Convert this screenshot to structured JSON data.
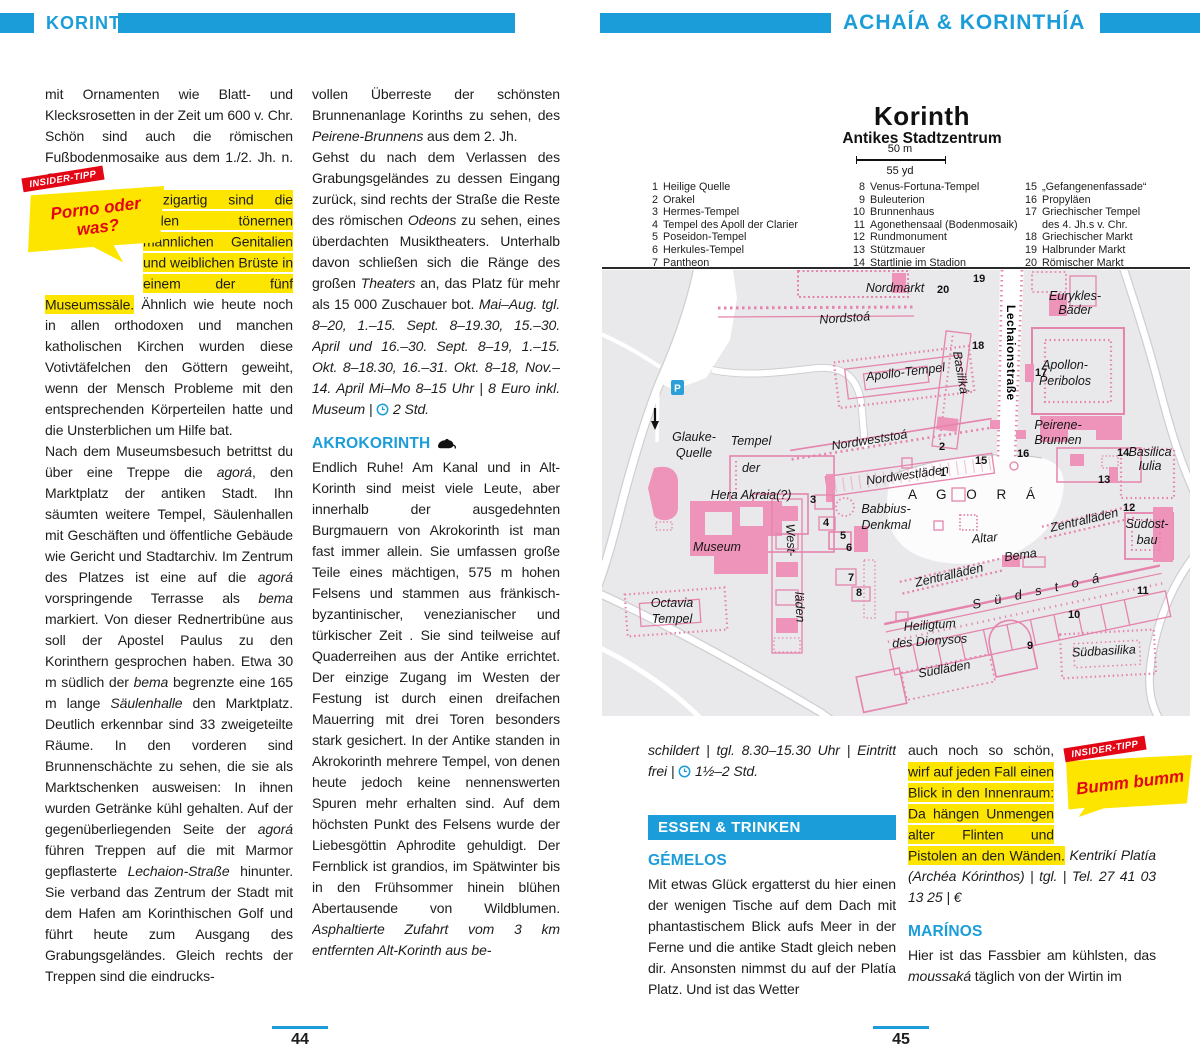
{
  "header": {
    "left_title": "KORINTH",
    "right_title": "ACHAÍA & KORINTHÍA",
    "accent": "#1b9dd9"
  },
  "pages": {
    "left_number": "44",
    "right_number": "45"
  },
  "tips": {
    "left": {
      "ribbon": "INSIDER-TIPP",
      "line1": "Porno oder",
      "line2": "was?"
    },
    "right": {
      "ribbon": "INSIDER-TIPP",
      "line1": "Bumm bumm",
      "line2": ""
    }
  },
  "p44c1": {
    "par1": [
      {
        "t": "mit Ornamenten wie Blatt- und Klecksrosetten in der Zeit um 600 v. Chr. Schön sind auch die römischen Fußbodenmosaike aus dem 1./2. Jh. n. Chr.",
        "s": "n"
      }
    ],
    "par2": [
      {
        "t": "Einzigartig sind die vielen tönernen männlichen Genitalien und weiblichen Brüste in einem der fünf Museumssäle.",
        "s": "m"
      },
      {
        "t": " Ähnlich wie heute noch in allen orthodoxen und manchen katholischen Kirchen wurden diese Votivtäfelchen den Göttern geweiht, wenn der Mensch Probleme mit den entsprechenden Körperteilen hatte und die Unsterblichen um Hilfe bat.",
        "s": "n"
      }
    ],
    "par3": [
      {
        "t": "Nach dem Museumsbesuch betrittst du über eine Treppe die ",
        "s": "n"
      },
      {
        "t": "agorá",
        "s": "i"
      },
      {
        "t": ", den Marktplatz der antiken Stadt. Ihn säumten weitere Tempel, Säulenhallen mit Geschäften und öffentliche Gebäude wie Gericht und Stadtarchiv. Im Zentrum des Platzes ist eine auf die ",
        "s": "n"
      },
      {
        "t": "agorá",
        "s": "i"
      },
      {
        "t": " vorspringende Terrasse als ",
        "s": "n"
      },
      {
        "t": "bema",
        "s": "i"
      },
      {
        "t": " markiert. Von dieser Rednertribüne aus soll der Apostel Paulus zu den Korinthern gesprochen haben. Etwa 30 m südlich der ",
        "s": "n"
      },
      {
        "t": "bema",
        "s": "i"
      },
      {
        "t": " begrenzte eine 165 m lange ",
        "s": "n"
      },
      {
        "t": "Säulenhalle",
        "s": "i"
      },
      {
        "t": " den Marktplatz. Deutlich erkennbar sind 33 zweigeteilte Räume. In den vorderen sind Brunnenschächte zu sehen, die sie als Marktschenken ausweisen: In ihnen wurden Getränke kühl gehalten. Auf der gegenüberliegenden Seite der ",
        "s": "n"
      },
      {
        "t": "agorá",
        "s": "i"
      },
      {
        "t": " führen Treppen auf die mit Marmor gepflasterte ",
        "s": "n"
      },
      {
        "t": "Lechaion-Straße",
        "s": "i"
      },
      {
        "t": " hinunter. Sie verband das Zentrum der Stadt mit dem Hafen am Korinthischen Golf und führt heute zum Ausgang des Grabungsgeländes. Gleich rechts der Treppen sind die eindrucks-",
        "s": "n"
      }
    ]
  },
  "p44c2": {
    "par1": [
      {
        "t": "vollen Überreste der schönsten Brunnenanlage Korinths zu sehen, des ",
        "s": "n"
      },
      {
        "t": "Peirene-Brunnens",
        "s": "i"
      },
      {
        "t": " aus dem 2. Jh.",
        "s": "n"
      }
    ],
    "par2": [
      {
        "t": "Gehst du nach dem Verlassen des Grabungsgeländes zu dessen Eingang zurück, sind rechts der Straße die Reste des römischen ",
        "s": "n"
      },
      {
        "t": "Odeons",
        "s": "i"
      },
      {
        "t": " zu sehen, eines überdachten Musiktheaters. Unterhalb davon schließen sich die Ränge des großen ",
        "s": "n"
      },
      {
        "t": "Theaters",
        "s": "i"
      },
      {
        "t": " an, das Platz für mehr als 15 000 Zuschauer bot. ",
        "s": "n"
      },
      {
        "t": "Mai–Aug. tgl. 8–20, 1.–15. Sept. 8–19.30, 15.–30. April und 16.–30. Sept. 8–19, 1.–15. Okt. 8–18.30, 16.–31. Okt. 8–18, Nov.–14. April Mi–Mo 8–15 Uhr | 8 Euro inkl. Museum | ",
        "s": "i"
      },
      {
        "t": "",
        "s": "clock"
      },
      {
        "t": " 2 Std.",
        "s": "i"
      }
    ],
    "heading": "AKROKORINTH",
    "par3": [
      {
        "t": "Endlich Ruhe! Am Kanal und in Alt-Korinth sind meist viele Leute, aber innerhalb der ausgedehnten Burgmauern von Akrokorinth ist man fast immer allein. Sie umfassen große Teile eines mächtigen, 575 m hohen Felsens und stammen aus fränkisch-byzantinischer, venezianischer und türkischer Zeit . Sie sind teilweise auf Quaderreihen aus der Antike errichtet. Der einzige Zugang im Westen der Festung ist durch einen dreifachen Mauerring mit drei Toren besonders stark gesichert. In der Antike standen in Akrokorinth mehrere Tempel, von denen heute jedoch keine nennenswerten Spuren mehr erhalten sind. Auf dem höchsten Punkt des Felsens wurde der Liebesgöttin Aphrodite gehuldigt. Der Fernblick ist grandios, im Spätwinter bis in den Frühsommer hinein blühen Abertausende von Wildblumen. ",
        "s": "n"
      },
      {
        "t": "Asphaltierte Zufahrt vom 3 km entfernten Alt-Korinth aus be-",
        "s": "i"
      }
    ]
  },
  "p45c1": {
    "par1": [
      {
        "t": "schildert | tgl. 8.30–15.30 Uhr | Eintritt frei | ",
        "s": "i"
      },
      {
        "t": "",
        "s": "clock"
      },
      {
        "t": " 1½–2 Std.",
        "s": "i"
      }
    ],
    "banner": "ESSEN & TRINKEN",
    "heading": "GÉMELOS",
    "par2": [
      {
        "t": "Mit etwas Glück ergatterst du hier einen der wenigen Tische auf dem Dach mit phantastischem Blick aufs Meer in der Ferne und die antike Stadt gleich neben dir. Ansonsten nimmst du auf der Platía Platz. Und ist das Wetter",
        "s": "n"
      }
    ]
  },
  "p45c2": {
    "par1": [
      {
        "t": "auch noch so schön, ",
        "s": "n"
      },
      {
        "t": "wirf auf jeden Fall einen Blick in den Innenraum: Da hängen Unmengen alter Flinten und Pistolen an den Wänden.",
        "s": "m"
      },
      {
        "t": " ",
        "s": "n"
      },
      {
        "t": "Kentrikí Platía (Archéa Kórinthos) | tgl. | Tel. 27 41 03 13 25 | €",
        "s": "i"
      }
    ],
    "heading": "MARÍNOS",
    "par2": [
      {
        "t": "Hier ist das Fassbier am kühlsten, das ",
        "s": "n"
      },
      {
        "t": "moussaká",
        "s": "i"
      },
      {
        "t": " täglich von der Wirtin im",
        "s": "n"
      }
    ]
  },
  "map": {
    "title": "Korinth",
    "subtitle": "Antikes Stadtzentrum",
    "scale_m": "50 m",
    "scale_yd": "55 yd",
    "parking": "P",
    "legend": [
      {
        "n": "1",
        "label": "Heilige Quelle"
      },
      {
        "n": "2",
        "label": "Orakel"
      },
      {
        "n": "3",
        "label": "Hermes-Tempel"
      },
      {
        "n": "4",
        "label": "Tempel des Apoll der Clarier"
      },
      {
        "n": "5",
        "label": "Poseidon-Tempel"
      },
      {
        "n": "6",
        "label": "Herkules-Tempel"
      },
      {
        "n": "7",
        "label": "Pantheon"
      },
      {
        "n": "8",
        "label": "Venus-Fortuna-Tempel"
      },
      {
        "n": "9",
        "label": "Buleuterion"
      },
      {
        "n": "10",
        "label": "Brunnenhaus"
      },
      {
        "n": "11",
        "label": "Agonethensaal (Bodenmosaik)"
      },
      {
        "n": "12",
        "label": "Rundmonument"
      },
      {
        "n": "13",
        "label": "Stützmauer"
      },
      {
        "n": "14",
        "label": "Startlinie im Stadion"
      },
      {
        "n": "15",
        "label": "„Gefangenenfassade“"
      },
      {
        "n": "16",
        "label": "Propyläen"
      },
      {
        "n": "17",
        "label": "Griechischer Tempel",
        "label2": "des 4. Jh.s v. Chr."
      },
      {
        "n": "18",
        "label": "Griechischer Markt"
      },
      {
        "n": "19",
        "label": "Halbrunder Markt"
      },
      {
        "n": "20",
        "label": "Römischer Markt"
      }
    ],
    "labels": {
      "nordmarkt": "Nordmarkt",
      "nordstoa": "Nordstoá",
      "apollotempel": "Apollo-Tempel",
      "eurykles1": "Eurykles-",
      "eurykles2": "Bäder",
      "peribolos1": "Apollon-",
      "peribolos2": "Peribolos",
      "peirene1": "Peirene-",
      "peirene2": "Brunnen",
      "basilicaiulia1": "Basilica",
      "basilicaiulia2": "Iulia",
      "lechaion": "Lechaionstraße",
      "basilika": "Basiliká",
      "nordweststoa": "Nordweststoá",
      "nordwestlaeden": "Nordwestläden",
      "glauke1": "Glauke-",
      "glauke2": "Quelle",
      "hera1": "Tempel",
      "hera2": "der",
      "hera3": "Hera Akraia(?)",
      "museum": "Museum",
      "octavia1": "Octavia",
      "octavia2": "Tempel",
      "westlaeden1": "West-",
      "westlaeden2": "läden",
      "babbius1": "Babbius-",
      "babbius2": "Denkmal",
      "agora": "A G O R Á",
      "altar": "Altar",
      "bema": "Bema",
      "zentrallaeden1": "Zentralläden",
      "zentrallaeden2": "Zentralläden",
      "suedostbau1": "Südost-",
      "suedostbau2": "bau",
      "suedstoa": "S ü d s t o á",
      "dionysos1": "Heiligtum",
      "dionysos2": "des Dionysos",
      "suedlaeden": "Südläden",
      "suedbasilika": "Südbasilika"
    },
    "numbers": {
      "n1": "1",
      "n2": "2",
      "n3": "3",
      "n4": "4",
      "n5": "5",
      "n6": "6",
      "n7": "7",
      "n8": "8",
      "n9": "9",
      "n10": "10",
      "n11": "11",
      "n12": "12",
      "n13": "13",
      "n14": "14",
      "n15": "15",
      "n16": "16",
      "n17": "17",
      "n18": "18",
      "n19": "19",
      "n20": "20"
    }
  }
}
